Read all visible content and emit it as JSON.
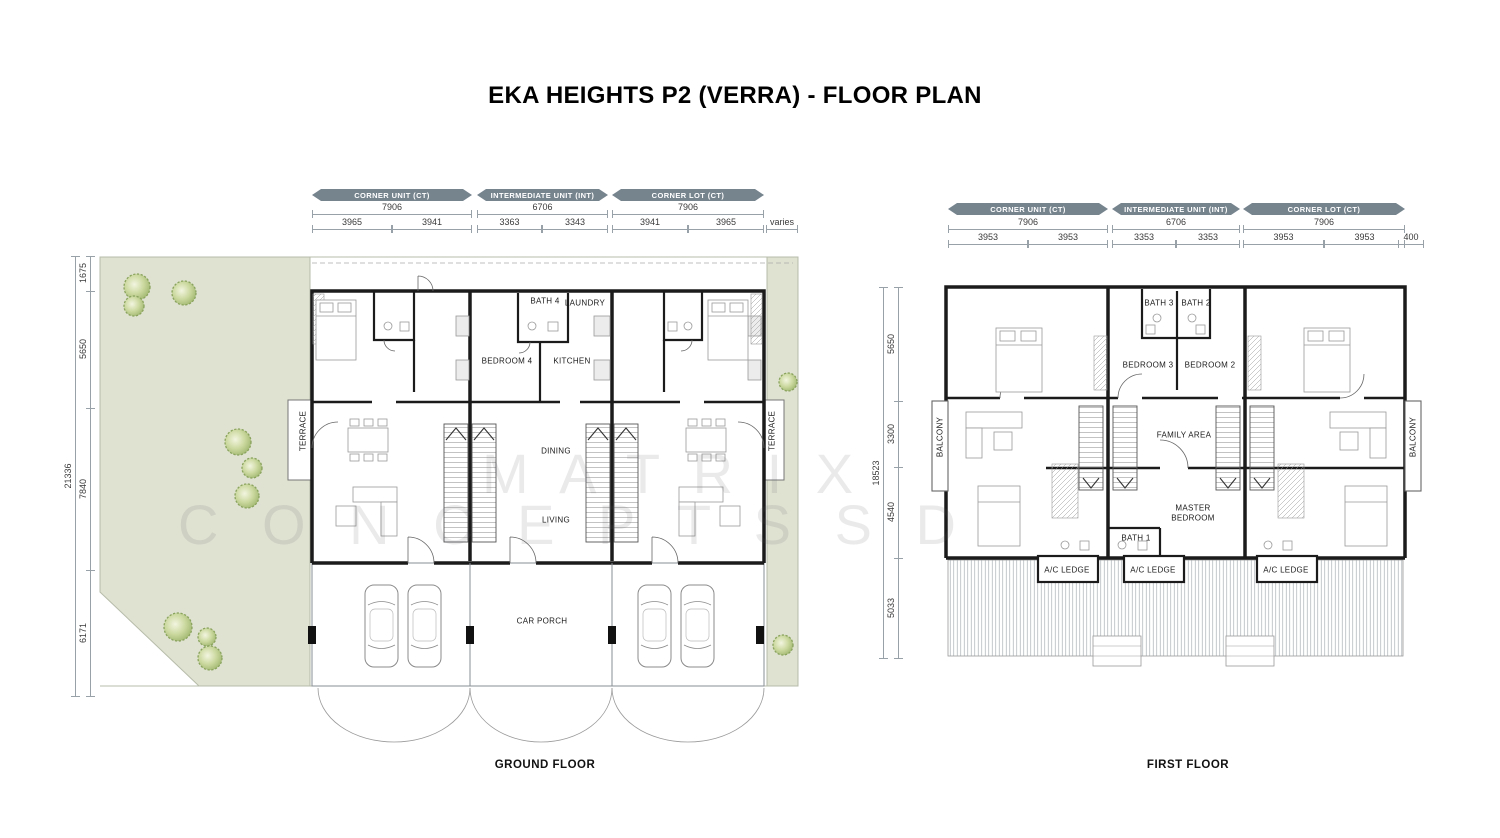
{
  "title": "EKA HEIGHTS P2 (VERRA) - FLOOR PLAN",
  "watermark": {
    "line1": "M A T R I X",
    "line2": "C O N C E P T S  S D"
  },
  "colors": {
    "unit_bar": "#76848E",
    "landscape": "#DFE2D1",
    "tree": "#B7C787",
    "wall": "#1B1B1B"
  },
  "ground_floor": {
    "caption": "GROUND FLOOR",
    "unit_headers": [
      "CORNER UNIT (CT)",
      "INTERMEDIATE UNIT (INT)",
      "CORNER LOT (CT)"
    ],
    "width_dims_units": [
      "7906",
      "6706",
      "7906"
    ],
    "width_dims_sub": [
      "3965",
      "3941",
      "3363",
      "3343",
      "3941",
      "3965",
      "varies"
    ],
    "height_dim_total": "21336",
    "height_dims": [
      "1675",
      "5650",
      "7840",
      "6171"
    ],
    "rooms": {
      "bath4": "BATH 4",
      "laundry": "LAUNDRY",
      "bedroom4": "BEDROOM 4",
      "kitchen": "KITCHEN",
      "dining": "DINING",
      "living": "LIVING",
      "car_porch": "CAR PORCH",
      "terrace": "TERRACE"
    }
  },
  "first_floor": {
    "caption": "FIRST FLOOR",
    "unit_headers": [
      "CORNER UNIT (CT)",
      "INTERMEDIATE UNIT (INT)",
      "CORNER LOT (CT)"
    ],
    "width_dims_units": [
      "7906",
      "6706",
      "7906"
    ],
    "width_dims_sub": [
      "3953",
      "3953",
      "3353",
      "3353",
      "3953",
      "3953",
      "400"
    ],
    "height_dim_total": "18523",
    "height_dims": [
      "5650",
      "3300",
      "4540",
      "5033"
    ],
    "rooms": {
      "bath3": "BATH 3",
      "bath2": "BATH 2",
      "bedroom3": "BEDROOM 3",
      "bedroom2": "BEDROOM 2",
      "family_area": "FAMILY AREA",
      "master_bedroom": "MASTER BEDROOM",
      "bath1": "BATH 1",
      "ac_ledge": "A/C LEDGE",
      "balcony": "BALCONY"
    }
  }
}
